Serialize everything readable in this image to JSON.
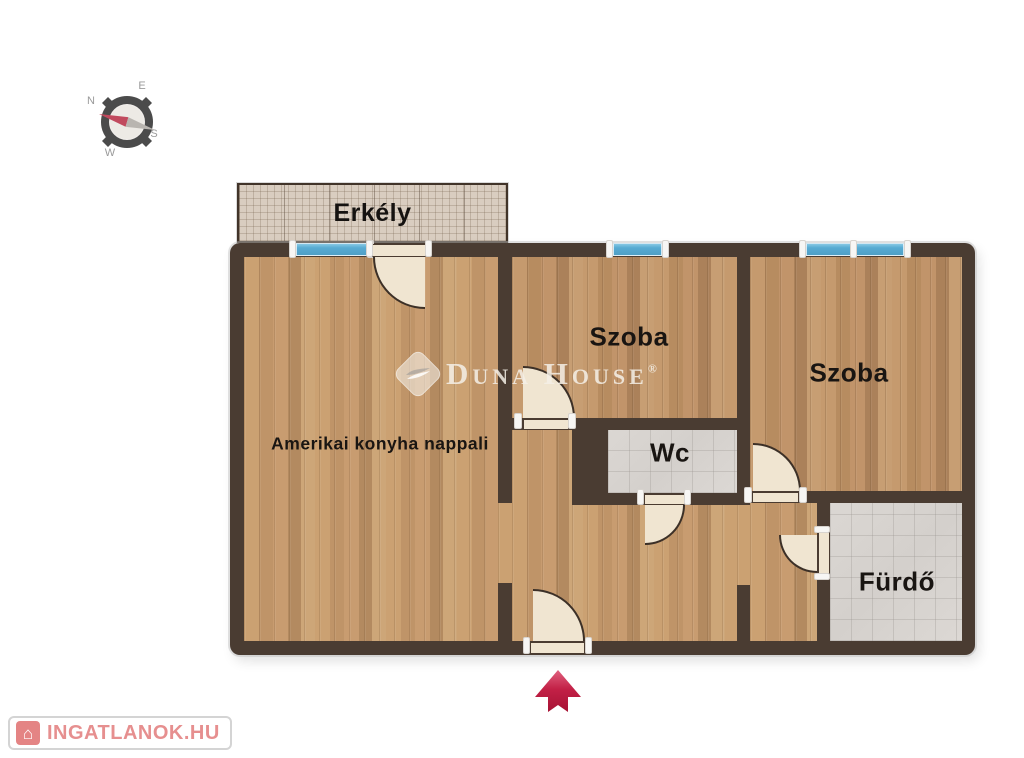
{
  "title": "Lakás alaprajz",
  "compass": {
    "n": "N",
    "e": "E",
    "s": "S",
    "w": "W"
  },
  "balcony": {
    "label": "Erkély"
  },
  "rooms": {
    "living": {
      "label": "Amerikai konyha nappali"
    },
    "bedroom1": {
      "label": "Szoba"
    },
    "bedroom2": {
      "label": "Szoba"
    },
    "wc": {
      "label": "Wc"
    },
    "bathroom": {
      "label": "Fürdő"
    }
  },
  "watermark": {
    "brand": "Duna House",
    "reg": "®"
  },
  "footer_logo": {
    "text": "INGATLANOK.HU",
    "glyph": "⌂"
  },
  "colors": {
    "wall": "#4a3c32",
    "door": "#f0e5d1",
    "window-blue": "#58abd2",
    "tile-gray": "#d8d4d0",
    "arrow-red": "#c22046",
    "balcony-floor": "#d9cdc0"
  }
}
